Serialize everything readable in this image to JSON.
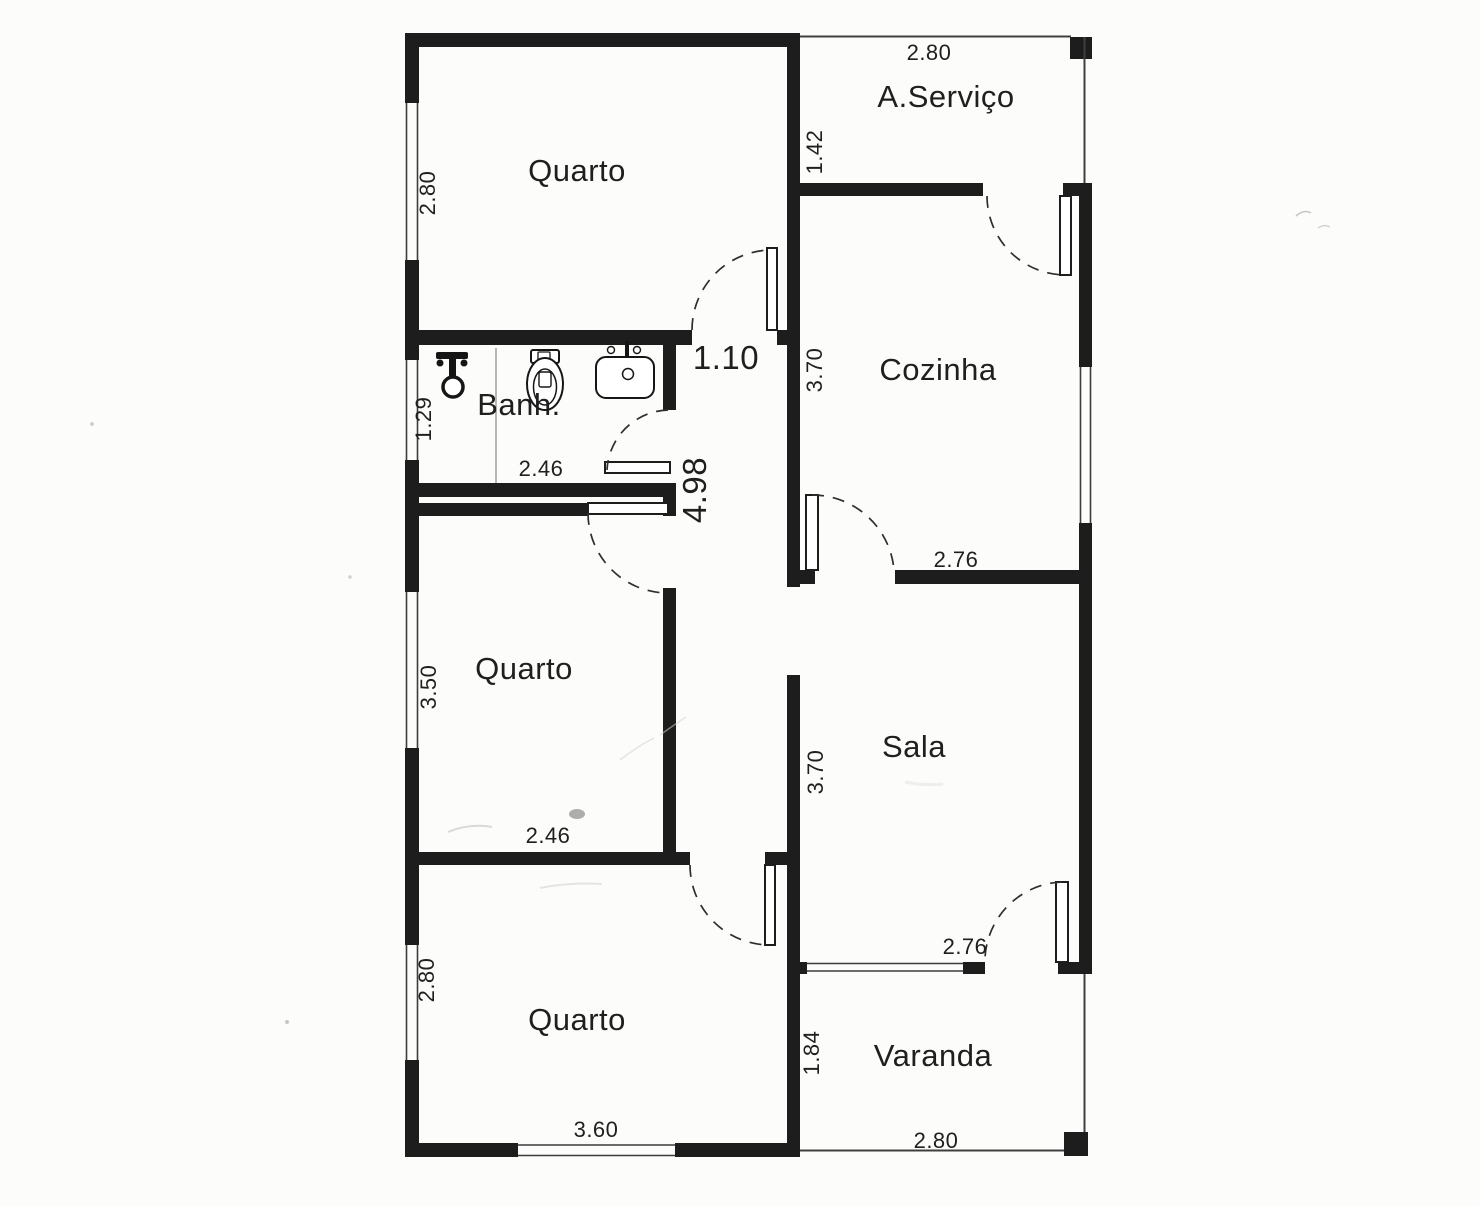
{
  "colors": {
    "wall": "#1d1d1d",
    "paper": "#fcfcfa",
    "ink": "#1f1f1f"
  },
  "rooms": {
    "quarto_top": {
      "name": "Quarto",
      "dim_left": "2.80"
    },
    "area_servico": {
      "name": "A.Serviço",
      "dim_top": "2.80",
      "dim_left": "1.42"
    },
    "cozinha": {
      "name": "Cozinha",
      "dim_left": "3.70",
      "dim_bottom": "2.76"
    },
    "banheiro": {
      "name": "Banh.",
      "dim_left": "1.29",
      "dim_bottom": "2.46"
    },
    "hall": {
      "dim_width": "1.10",
      "dim_length": "4.98"
    },
    "quarto_meio": {
      "name": "Quarto",
      "dim_left": "3.50",
      "dim_bottom": "2.46"
    },
    "sala": {
      "name": "Sala",
      "dim_left": "3.70",
      "dim_bottom": "2.76"
    },
    "quarto_baixo": {
      "name": "Quarto",
      "dim_left": "2.80",
      "dim_bottom": "3.60"
    },
    "varanda": {
      "name": "Varanda",
      "dim_left": "1.84",
      "dim_bottom": "2.80"
    }
  },
  "fixtures": {
    "shower": "shower-mixer",
    "toilet": "toilet",
    "sink": "washbasin"
  }
}
